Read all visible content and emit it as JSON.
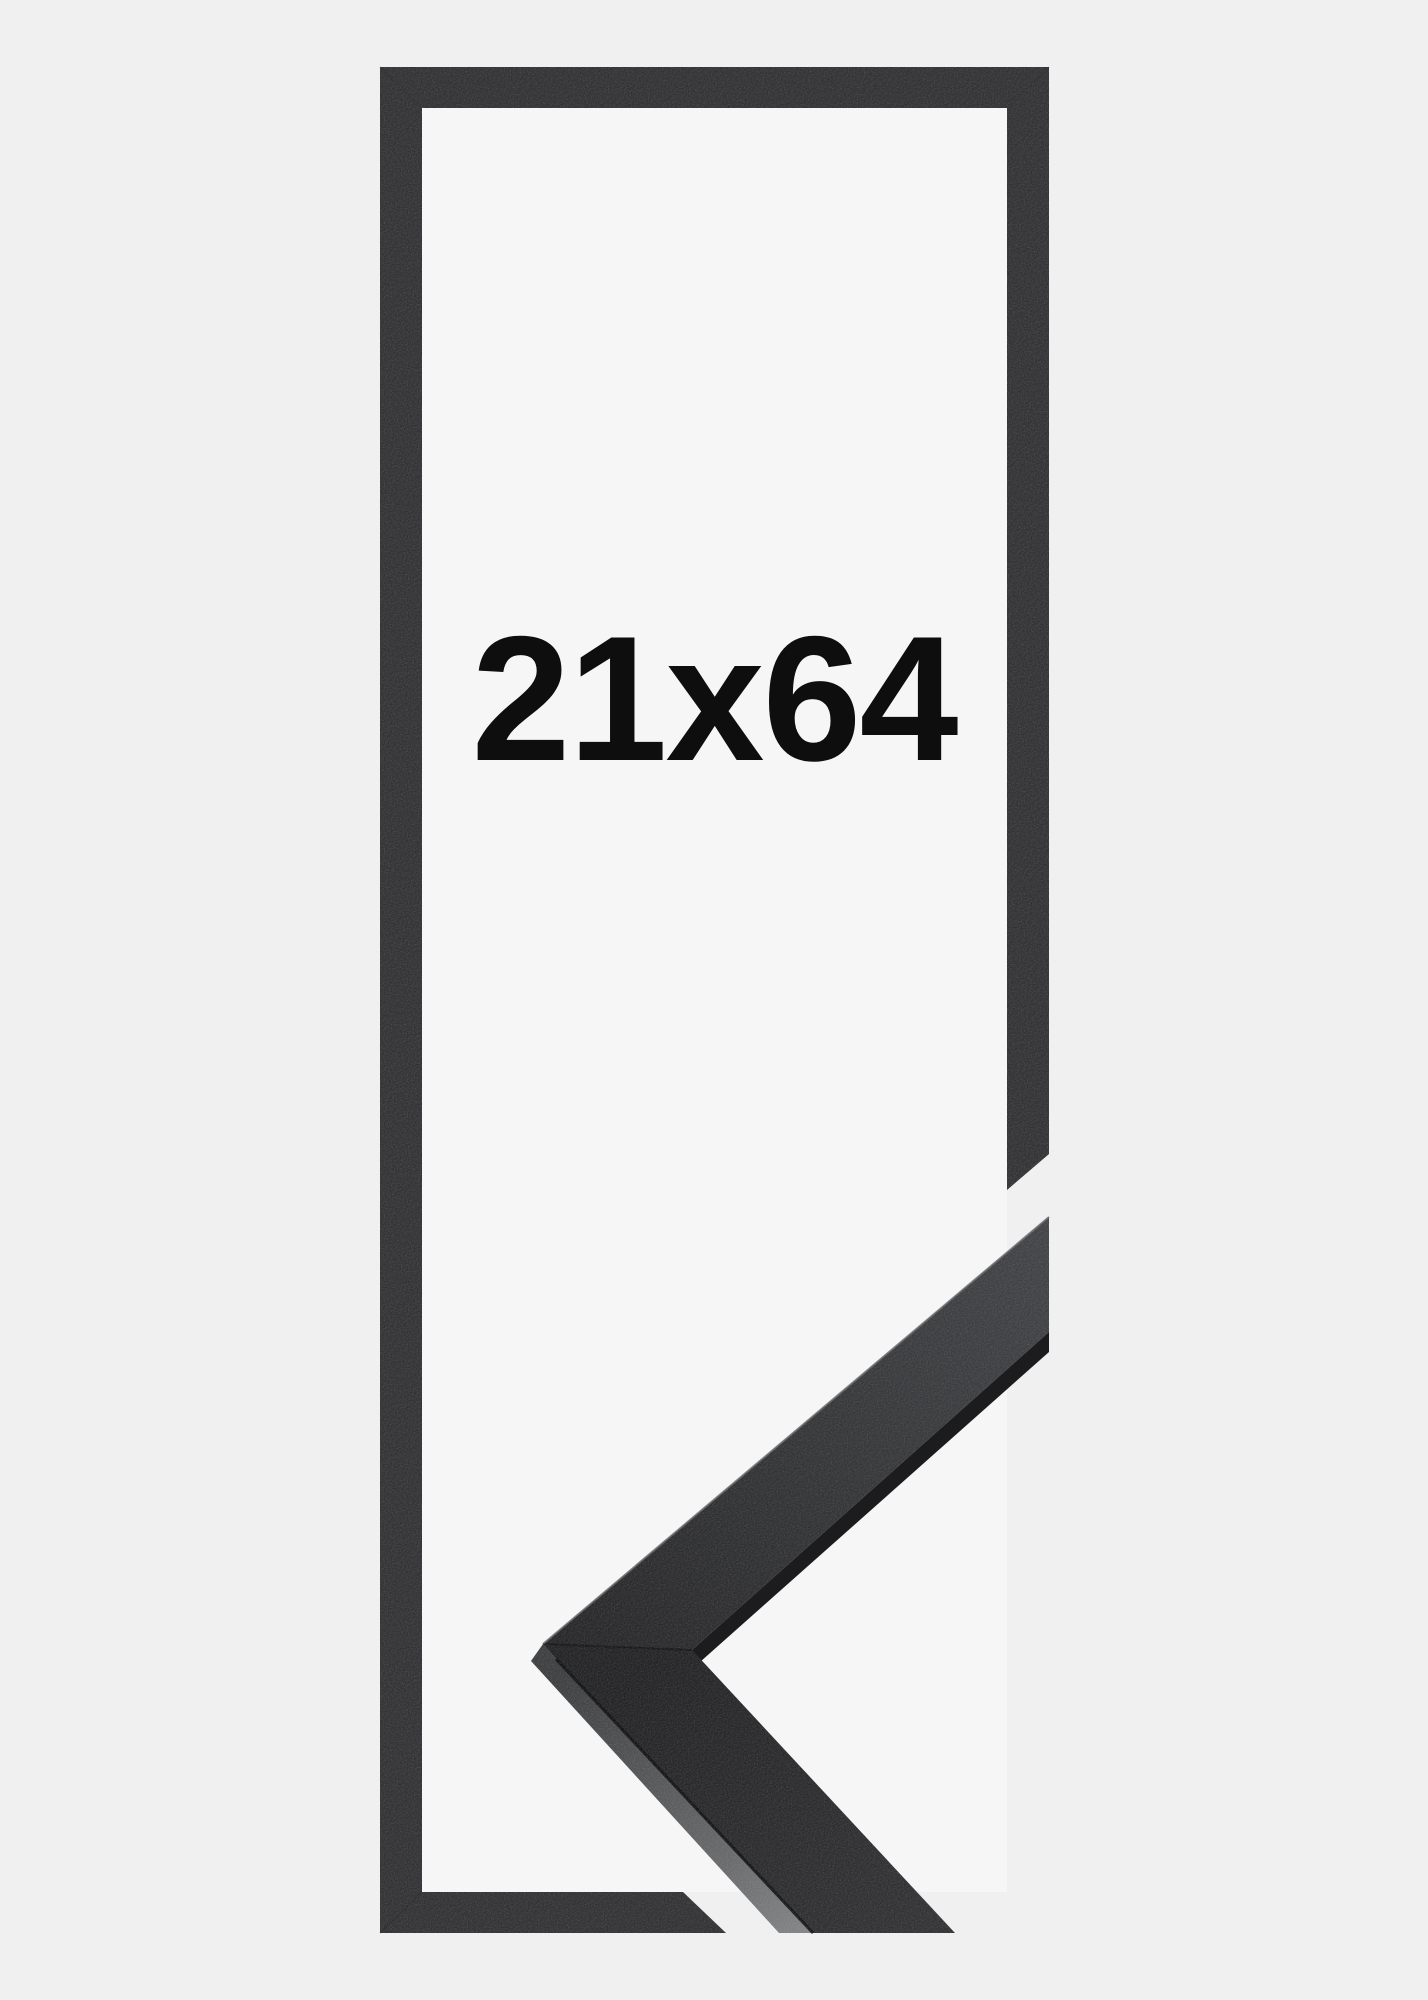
{
  "image": {
    "size_label": "21x64",
    "colors": {
      "background": "#f0f0f1",
      "window_background": "#f6f6f7",
      "frame_outline": "#323235",
      "label_text": "#0e0e0f"
    }
  }
}
